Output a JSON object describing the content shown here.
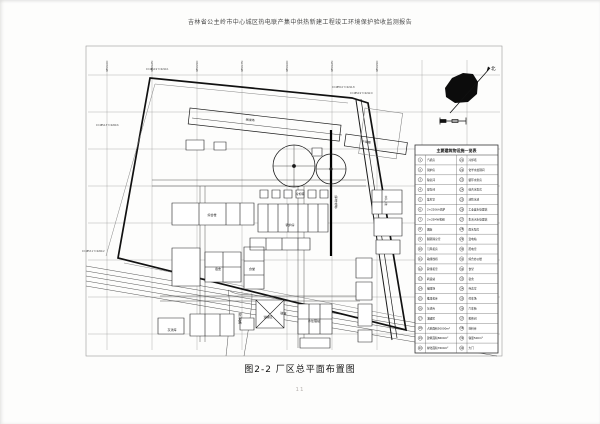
{
  "page": {
    "header": "吉林省公主岭市中心城区热电联产集中供热新建工程竣工环境保护验收监测报告",
    "caption": "图2-2 厂区总平面布置图",
    "page_number": "11"
  },
  "drawing": {
    "north_label": "北",
    "grid_labels": [
      {
        "x": 107,
        "text": "4853.00"
      },
      {
        "x": 152,
        "text": "4853.25"
      },
      {
        "x": 197,
        "text": "4853.50"
      },
      {
        "x": 242,
        "text": "4853.75"
      },
      {
        "x": 287,
        "text": "4854.00"
      },
      {
        "x": 332,
        "text": "4854.25"
      },
      {
        "x": 377,
        "text": "4854.50"
      }
    ],
    "coord_labels": [
      {
        "x": 96,
        "y": 126,
        "t": "X=4854.3 Y=2209.6"
      },
      {
        "x": 82,
        "y": 252,
        "t": "X=4853.1 Y=2209.2"
      },
      {
        "x": 146,
        "y": 70,
        "t": "X=4854.9 Y=2210.1"
      },
      {
        "x": 332,
        "y": 88,
        "t": "X=4855.0 Y=2211.8"
      },
      {
        "x": 350,
        "y": 94,
        "t": "X=4854.9 Y=2212.0"
      }
    ],
    "plan_labels": [
      {
        "x": 250,
        "y": 121,
        "t": "储煤场",
        "r": 7
      },
      {
        "x": 366,
        "y": 143,
        "t": "干煤棚",
        "r": 8
      },
      {
        "x": 300,
        "y": 195,
        "t": "冷却塔"
      },
      {
        "x": 336,
        "y": 198,
        "t": "输煤栈桥",
        "v": true
      },
      {
        "x": 290,
        "y": 226,
        "t": "锅炉房"
      },
      {
        "x": 386,
        "y": 198,
        "t": "主厂房",
        "v": true
      },
      {
        "x": 212,
        "y": 216,
        "t": "综合楼"
      },
      {
        "x": 218,
        "y": 270,
        "t": "宿舍"
      },
      {
        "x": 252,
        "y": 270,
        "t": "食堂"
      },
      {
        "x": 268,
        "y": 318,
        "t": "油罐区"
      },
      {
        "x": 314,
        "y": 322,
        "t": "水处理站"
      },
      {
        "x": 172,
        "y": 331,
        "t": "灰渣库"
      }
    ],
    "road_labels": {
      "south_road": "道路",
      "branch_road": "规划路"
    }
  },
  "legend": {
    "title": "主要建筑物设施一览表",
    "entries_left": [
      "汽机房",
      "锅炉房",
      "除氧间",
      "煤仓间",
      "集控室",
      "2×220t/h锅炉",
      "2×25MW机组",
      "烟囱",
      "脱硫除尘室",
      "引风机房",
      "输煤栈桥",
      "碎煤机室",
      "转运站",
      "储煤场",
      "推煤机库",
      "灰渣库",
      "油罐区",
      "占地面积50000m²",
      "建筑面积8600m²",
      "绿化面积7600m²"
    ],
    "entries_right": [
      "冷却塔",
      "化学水处理间",
      "循环水泵房",
      "综合水泵房",
      "消防水池",
      "工业废水处理站",
      "生活污水处理站",
      "雨水泵房",
      "变电站",
      "配电室",
      "综合办公楼",
      "食堂",
      "宿舍",
      "传达室",
      "停车场",
      "汽车衡",
      "检修间",
      "材料库",
      "容量500m³",
      "大门"
    ]
  }
}
